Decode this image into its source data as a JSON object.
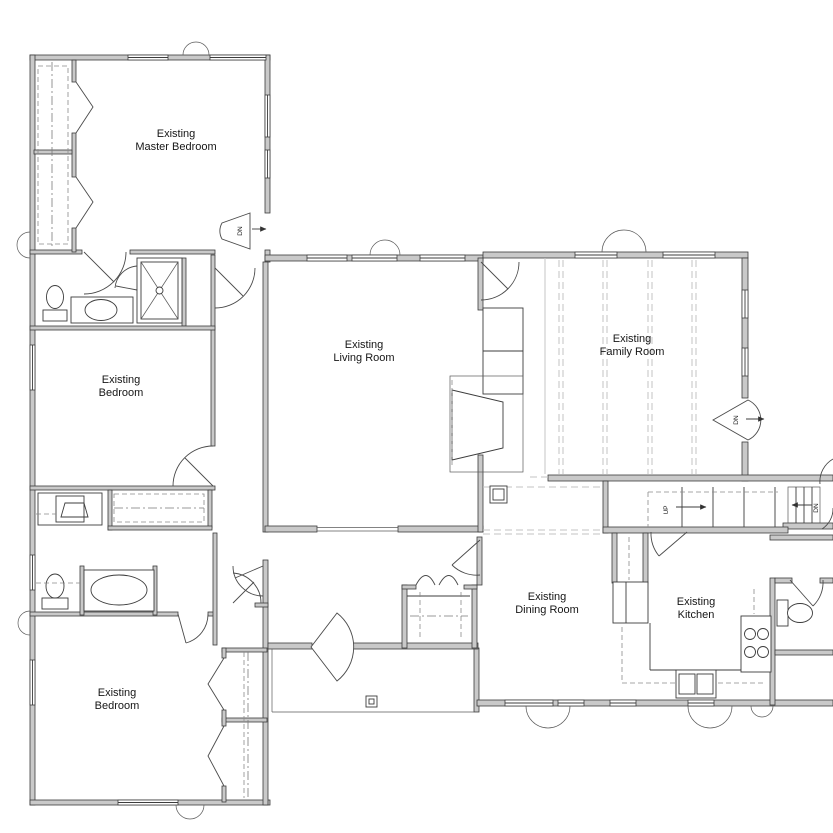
{
  "rooms": {
    "master_bedroom": {
      "line1": "Existing",
      "line2": "Master Bedroom"
    },
    "bedroom_mid": {
      "line1": "Existing",
      "line2": "Bedroom"
    },
    "bedroom_bottom": {
      "line1": "Existing",
      "line2": "Bedroom"
    },
    "living": {
      "line1": "Existing",
      "line2": "Living Room"
    },
    "family": {
      "line1": "Existing",
      "line2": "Family Room"
    },
    "dining": {
      "line1": "Existing",
      "line2": "Dining Room"
    },
    "kitchen": {
      "line1": "Existing",
      "line2": "Kitchen"
    }
  },
  "labels": {
    "up": "UP",
    "dn": "DN"
  },
  "icons": {
    "fixtures": [
      "toilet",
      "bathtub",
      "shower",
      "vanity-sink",
      "kitchen-sink",
      "stove",
      "refrigerator",
      "fireplace"
    ],
    "symbols": [
      "door-swing-arc",
      "bifold-door",
      "window",
      "shrub",
      "stairs",
      "step-down-fan"
    ]
  },
  "colors": {
    "wall_fill": "#c9c9c9",
    "line": "#3c3c3c",
    "light_gray": "#c6c6c6",
    "background": "#ffffff"
  }
}
